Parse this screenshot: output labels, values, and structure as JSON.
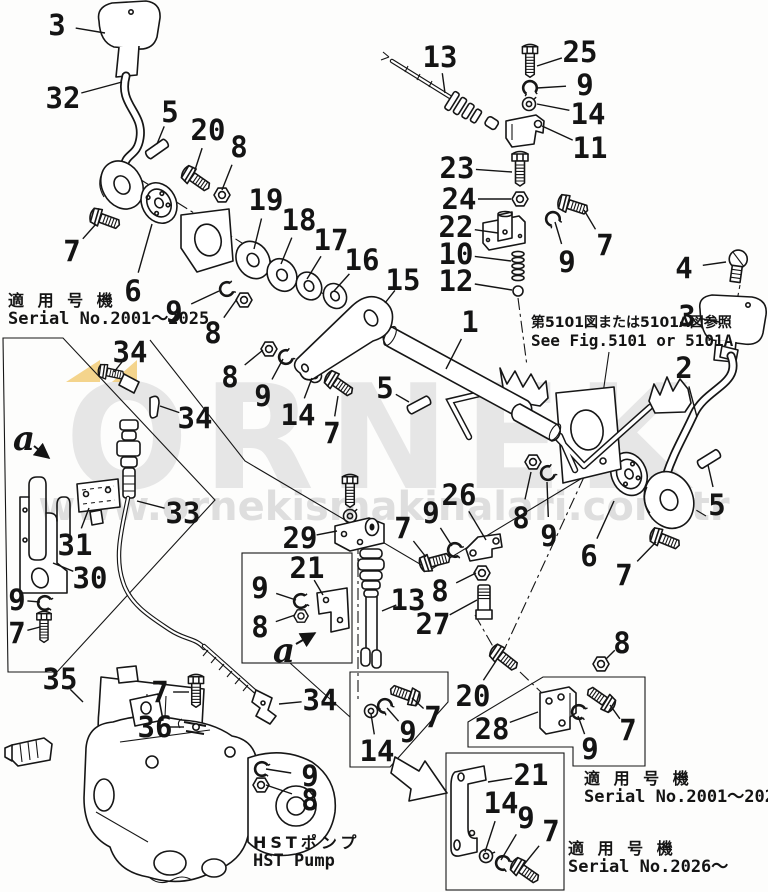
{
  "title": "HST pump control lever exploded parts diagram",
  "watermark": {
    "brand": "ORNEK",
    "url": "www.ornekismakinalari.com.tr",
    "accent_yellow": "#f3cf80",
    "gray_big": "#e6e6e6",
    "gray_url": "#dedede"
  },
  "annotations": {
    "serial_top_left": {
      "jp": "適 用 号 機",
      "en": "Serial No.2001～2025"
    },
    "fig_ref": {
      "jp": "第5101図または5101A図参照",
      "en": "See Fig.5101 or 5101A"
    },
    "serial_bottom_mid": {
      "jp": "適 用 号 機",
      "en": "Serial No.2001～2025"
    },
    "serial_bottom_right": {
      "jp": "適 用 号 機",
      "en": "Serial No.2026～"
    },
    "pump_label": {
      "jp": "HSTポンプ",
      "en": "HST Pump"
    }
  },
  "view_labels": [
    {
      "t": "a",
      "x": 24,
      "y": 438,
      "x1": 34,
      "y1": 446,
      "x2": 49,
      "y2": 458
    },
    {
      "t": "a",
      "x": 284,
      "y": 650,
      "x1": 296,
      "y1": 644,
      "x2": 315,
      "y2": 633
    }
  ],
  "callouts": [
    {
      "label": "3",
      "lx": 57,
      "ly": 25,
      "tx": 105,
      "ty": 33
    },
    {
      "label": "32",
      "lx": 63,
      "ly": 98,
      "tx": 122,
      "ty": 82
    },
    {
      "label": "5",
      "lx": 170,
      "ly": 112,
      "tx": 157,
      "ty": 144
    },
    {
      "label": "20",
      "lx": 208,
      "ly": 130,
      "tx": 194,
      "ty": 173
    },
    {
      "label": "8",
      "lx": 239,
      "ly": 147,
      "tx": 222,
      "ty": 190
    },
    {
      "label": "7",
      "lx": 72,
      "ly": 251,
      "tx": 96,
      "ty": 224
    },
    {
      "label": "6",
      "lx": 133,
      "ly": 291,
      "tx": 152,
      "ty": 224
    },
    {
      "label": "19",
      "lx": 266,
      "ly": 200,
      "tx": 254,
      "ty": 249
    },
    {
      "label": "18",
      "lx": 299,
      "ly": 220,
      "tx": 281,
      "ty": 264
    },
    {
      "label": "17",
      "lx": 331,
      "ly": 240,
      "tx": 307,
      "ty": 279
    },
    {
      "label": "16",
      "lx": 362,
      "ly": 260,
      "tx": 334,
      "ty": 291
    },
    {
      "label": "9",
      "lx": 174,
      "ly": 312,
      "tx": 219,
      "ty": 291
    },
    {
      "label": "8",
      "lx": 213,
      "ly": 333,
      "tx": 237,
      "ty": 299
    },
    {
      "label": "13",
      "lx": 440,
      "ly": 57,
      "tx": 445,
      "ty": 93
    },
    {
      "label": "25",
      "lx": 580,
      "ly": 52,
      "tx": 537,
      "ty": 66
    },
    {
      "label": "9",
      "lx": 585,
      "ly": 85,
      "tx": 537,
      "ty": 88
    },
    {
      "label": "14",
      "lx": 588,
      "ly": 114,
      "tx": 537,
      "ty": 104
    },
    {
      "label": "11",
      "lx": 590,
      "ly": 148,
      "tx": 542,
      "ty": 126
    },
    {
      "label": "23",
      "lx": 457,
      "ly": 168,
      "tx": 512,
      "ty": 172
    },
    {
      "label": "24",
      "lx": 459,
      "ly": 199,
      "tx": 511,
      "ty": 199
    },
    {
      "label": "22",
      "lx": 456,
      "ly": 227,
      "tx": 498,
      "ty": 233
    },
    {
      "label": "10",
      "lx": 456,
      "ly": 254,
      "tx": 511,
      "ty": 261
    },
    {
      "label": "12",
      "lx": 456,
      "ly": 281,
      "tx": 512,
      "ty": 290
    },
    {
      "label": "7",
      "lx": 605,
      "ly": 245,
      "tx": 584,
      "ty": 210
    },
    {
      "label": "9",
      "lx": 567,
      "ly": 262,
      "tx": 555,
      "ty": 222
    },
    {
      "label": "4",
      "lx": 684,
      "ly": 268,
      "tx": 726,
      "ty": 262
    },
    {
      "label": "3",
      "lx": 687,
      "ly": 316,
      "tx": 719,
      "ty": 322
    },
    {
      "label": "2",
      "lx": 684,
      "ly": 368,
      "tx": 697,
      "ty": 417
    },
    {
      "label": "5",
      "lx": 717,
      "ly": 505,
      "tx": 708,
      "ty": 465
    },
    {
      "label": "8",
      "lx": 521,
      "ly": 518,
      "tx": 531,
      "ty": 472
    },
    {
      "label": "9",
      "lx": 549,
      "ly": 536,
      "tx": 547,
      "ty": 482
    },
    {
      "label": "6",
      "lx": 589,
      "ly": 556,
      "tx": 614,
      "ty": 501
    },
    {
      "label": "7",
      "lx": 624,
      "ly": 575,
      "tx": 656,
      "ty": 542
    },
    {
      "label": "8",
      "lx": 622,
      "ly": 643,
      "tx": 606,
      "ty": 659
    },
    {
      "label": "15",
      "lx": 403,
      "ly": 280,
      "tx": 385,
      "ty": 303
    },
    {
      "label": "1",
      "lx": 470,
      "ly": 322,
      "tx": 446,
      "ty": 369
    },
    {
      "label": "5",
      "lx": 385,
      "ly": 388,
      "tx": 409,
      "ty": 402
    },
    {
      "label": "8",
      "lx": 230,
      "ly": 377,
      "tx": 263,
      "ty": 350
    },
    {
      "label": "9",
      "lx": 263,
      "ly": 396,
      "tx": 283,
      "ty": 359
    },
    {
      "label": "14",
      "lx": 298,
      "ly": 415,
      "tx": 312,
      "ty": 378
    },
    {
      "label": "7",
      "lx": 332,
      "ly": 433,
      "tx": 338,
      "ty": 396
    },
    {
      "label": "34",
      "lx": 130,
      "ly": 352,
      "tx": 114,
      "ty": 372
    },
    {
      "label": "34",
      "lx": 195,
      "ly": 418,
      "tx": 160,
      "ty": 406
    },
    {
      "label": "33",
      "lx": 183,
      "ly": 513,
      "tx": 137,
      "ty": 501
    },
    {
      "label": "31",
      "lx": 75,
      "ly": 545,
      "tx": 89,
      "ty": 508
    },
    {
      "label": "30",
      "lx": 90,
      "ly": 578,
      "tx": 53,
      "ty": 563
    },
    {
      "label": "9",
      "lx": 17,
      "ly": 600,
      "tx": 40,
      "ty": 602
    },
    {
      "label": "7",
      "lx": 17,
      "ly": 633,
      "tx": 40,
      "ty": 627
    },
    {
      "label": "29",
      "lx": 300,
      "ly": 538,
      "tx": 337,
      "ty": 531
    },
    {
      "label": "21",
      "lx": 307,
      "ly": 568,
      "tx": 323,
      "ty": 595
    },
    {
      "label": "9",
      "lx": 260,
      "ly": 588,
      "tx": 296,
      "ty": 600
    },
    {
      "label": "8",
      "lx": 260,
      "ly": 627,
      "tx": 295,
      "ty": 615
    },
    {
      "label": "13",
      "lx": 408,
      "ly": 600,
      "tx": 382,
      "ty": 611
    },
    {
      "label": "26",
      "lx": 459,
      "ly": 495,
      "tx": 486,
      "ty": 540
    },
    {
      "label": "9",
      "lx": 431,
      "ly": 513,
      "tx": 452,
      "ty": 546
    },
    {
      "label": "7",
      "lx": 403,
      "ly": 528,
      "tx": 426,
      "ty": 557
    },
    {
      "label": "8",
      "lx": 440,
      "ly": 591,
      "tx": 476,
      "ty": 573
    },
    {
      "label": "27",
      "lx": 433,
      "ly": 624,
      "tx": 477,
      "ty": 600
    },
    {
      "label": "35",
      "lx": 60,
      "ly": 679,
      "tx": 83,
      "ty": 702
    },
    {
      "label": "7",
      "lx": 160,
      "ly": 692,
      "tx": 189,
      "ty": 692
    },
    {
      "label": "36",
      "lx": 155,
      "ly": 727,
      "tx": 184,
      "ty": 727
    },
    {
      "label": "34",
      "lx": 320,
      "ly": 700,
      "tx": 279,
      "ty": 704
    },
    {
      "label": "9",
      "lx": 310,
      "ly": 776,
      "tx": 266,
      "ty": 769
    },
    {
      "label": "8",
      "lx": 310,
      "ly": 800,
      "tx": 266,
      "ty": 785
    },
    {
      "label": "20",
      "lx": 473,
      "ly": 696,
      "tx": 496,
      "ty": 661
    },
    {
      "label": "28",
      "lx": 492,
      "ly": 729,
      "tx": 538,
      "ty": 712
    },
    {
      "label": "9",
      "lx": 590,
      "ly": 749,
      "tx": 578,
      "ty": 716
    },
    {
      "label": "7",
      "lx": 628,
      "ly": 730,
      "tx": 610,
      "ty": 705
    },
    {
      "label": "14",
      "lx": 377,
      "ly": 751,
      "tx": 371,
      "ty": 714
    },
    {
      "label": "9",
      "lx": 408,
      "ly": 732,
      "tx": 387,
      "ty": 708
    },
    {
      "label": "7",
      "lx": 433,
      "ly": 717,
      "tx": 412,
      "ty": 698
    },
    {
      "label": "21",
      "lx": 531,
      "ly": 775,
      "tx": 488,
      "ty": 782
    },
    {
      "label": "14",
      "lx": 501,
      "ly": 803,
      "tx": 485,
      "ty": 852
    },
    {
      "label": "9",
      "lx": 526,
      "ly": 818,
      "tx": 501,
      "ty": 860
    },
    {
      "label": "7",
      "lx": 551,
      "ly": 831,
      "tx": 522,
      "ty": 867
    }
  ]
}
